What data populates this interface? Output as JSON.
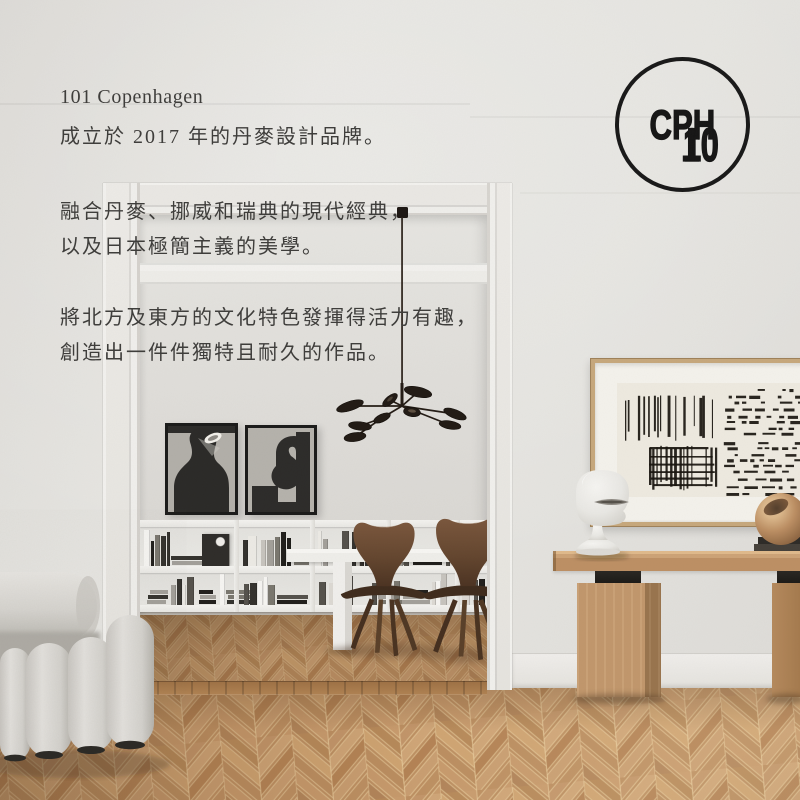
{
  "intro": {
    "lines": [
      "101 Copenhagen",
      "成立於 2017 年的丹麥設計品牌。",
      "融合丹麥、挪威和瑞典的現代經典，",
      "以及日本極簡主義的美學。",
      "將北方及東方的文化特色發揮得活力有趣，",
      "創造出一件件獨特且耐久的作品。"
    ]
  },
  "logo": {
    "line1_left": "10",
    "line1_flipped": "1",
    "line2": "CPH"
  },
  "palette": {
    "wall": "#e4e2de",
    "inner_wall": "#dedcd8",
    "text": "#3e3d3b",
    "ink": "#191919",
    "floor_light": "#c89a6b",
    "floor_dark": "#a87c50",
    "oak_console": "#c19267",
    "walnut_chair": "#5d4230",
    "boucle": "#d8d6d2",
    "art_frame_oak": "#c7a87c",
    "art_paper": "#eeeae0",
    "lamp_black": "#221b15"
  }
}
